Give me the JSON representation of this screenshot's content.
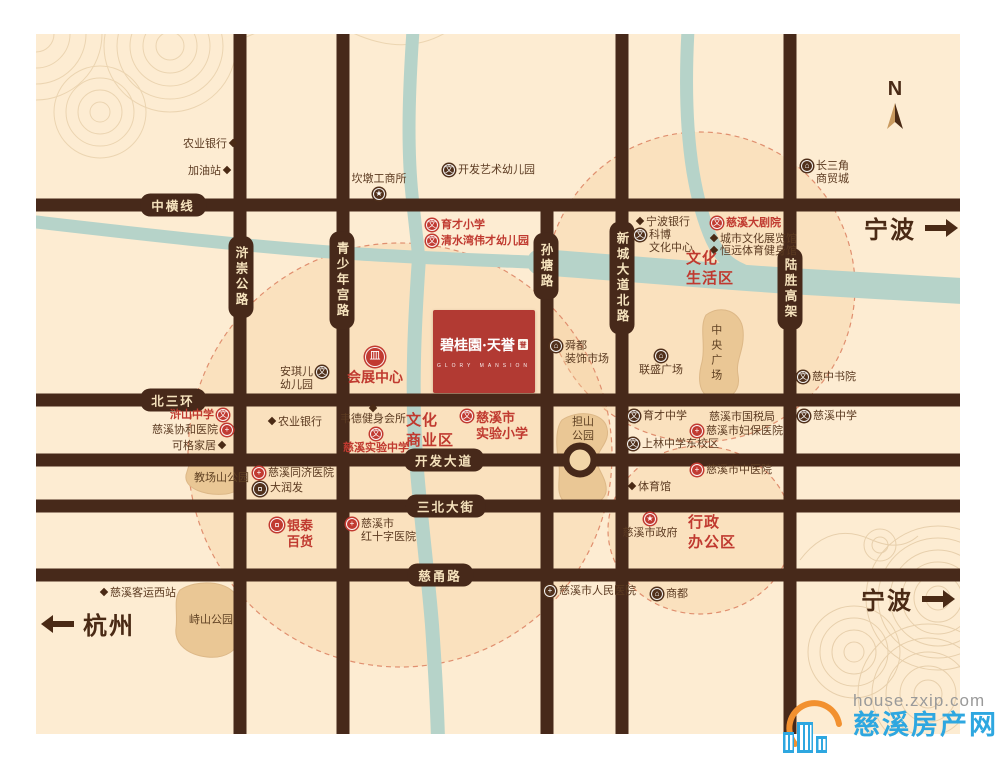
{
  "map": {
    "compass_label": "N",
    "project": {
      "name": "碧桂園·天誉",
      "seal": "誉",
      "subtitle": "GLORY MANSION"
    },
    "icon_glyphs": {
      "school": "文",
      "hospital": "+",
      "building": "⌂",
      "cart": "¤",
      "bank": "皿",
      "star": "★"
    },
    "colors": {
      "accent_red": "#c0392f",
      "road_brown": "#47291a",
      "river": "#b6d3c9",
      "cream": "#fdecd2",
      "park": "#eac795"
    },
    "road_labels": {
      "horizontal": [
        {
          "id": "zhonghengxian",
          "label": "中横线",
          "x": 173,
          "y": 205
        },
        {
          "id": "beisanhuan",
          "label": "北三环",
          "x": 173,
          "y": 400
        },
        {
          "id": "kaifa-avenue",
          "label": "开发大道",
          "x": 444,
          "y": 460
        },
        {
          "id": "sanbei-street",
          "label": "三北大街",
          "x": 446,
          "y": 506
        },
        {
          "id": "ciyong-road",
          "label": "慈甬路",
          "x": 440,
          "y": 575
        }
      ],
      "vertical": [
        {
          "id": "huchong-highway",
          "label": "浒崇公路",
          "x": 241,
          "y": 277
        },
        {
          "id": "qingshaoniangong-road",
          "label": "青少年宫路",
          "x": 342,
          "y": 280
        },
        {
          "id": "suntang-road",
          "label": "孙塘路",
          "x": 546,
          "y": 266
        },
        {
          "id": "xincheng-avenue-north",
          "label": "新城大道北路",
          "x": 622,
          "y": 278
        },
        {
          "id": "lusheng-viaduct",
          "label": "陆胜高架",
          "x": 790,
          "y": 289
        }
      ]
    },
    "districts": [
      {
        "id": "culture-living-zone",
        "label": "文化\n生活区",
        "x": 686,
        "y": 249
      },
      {
        "id": "culture-business-zone",
        "label": "文化\n商业区",
        "x": 406,
        "y": 411
      },
      {
        "id": "admin-office-zone",
        "label": "行政\n办公区",
        "x": 688,
        "y": 513
      }
    ],
    "parks": [
      {
        "id": "jiaochangshan-park",
        "label": "教场山公园",
        "x": 194,
        "y": 472
      },
      {
        "id": "danshan-park",
        "label": "担山\n公园",
        "x": 564,
        "y": 416,
        "center": true,
        "w": 38
      },
      {
        "id": "zhongyang-plaza",
        "label": "中央广场",
        "x": 708,
        "y": 324,
        "vertical": true
      },
      {
        "id": "zhishan-park",
        "label": "峙山公园",
        "x": 189,
        "y": 614
      }
    ],
    "pois": [
      {
        "id": "agri-bank-north",
        "label": "农业银行",
        "icon": "pin",
        "side": "right",
        "x": 183,
        "y": 138
      },
      {
        "id": "gas-station",
        "label": "加油站",
        "icon": "pin",
        "side": "right",
        "x": 188,
        "y": 165
      },
      {
        "id": "kandun-industry-office",
        "label": "坎墩工商所",
        "icon": "star-dark",
        "side": "bottom",
        "x": 341,
        "y": 173,
        "w": 76
      },
      {
        "id": "kaifa-art-kindergarten",
        "label": "开发艺术幼儿园",
        "icon": "school-dark",
        "side": "left",
        "x": 443,
        "y": 164
      },
      {
        "id": "yucai-primary-school",
        "label": "育才小学",
        "icon": "school-red",
        "side": "left",
        "accent": true,
        "x": 426,
        "y": 219
      },
      {
        "id": "qingshuiwan-kindergarten",
        "label": "清水湾伟才幼儿园",
        "icon": "school-red",
        "side": "left",
        "accent": true,
        "x": 426,
        "y": 235
      },
      {
        "id": "ningbo-bank",
        "label": "宁波银行",
        "icon": "pin",
        "side": "left",
        "x": 637,
        "y": 216
      },
      {
        "id": "kebo-culture-center",
        "label": "科博\n文化中心",
        "icon": "school-dark",
        "side": "left",
        "x": 634,
        "y": 229
      },
      {
        "id": "cixi-grand-theatre",
        "label": "慈溪大剧院",
        "icon": "school-red",
        "side": "left",
        "accent": true,
        "x": 711,
        "y": 217
      },
      {
        "id": "city-culture-expo-hall",
        "label": "城市文化展览馆",
        "icon": "pin",
        "side": "left",
        "x": 711,
        "y": 233
      },
      {
        "id": "hengyuan-sports-gym",
        "label": "恒远体育健身馆",
        "icon": "pin",
        "side": "left",
        "x": 711,
        "y": 245
      },
      {
        "id": "changsanjiao-trade-city",
        "label": "长三角\n商贸城",
        "icon": "building-dark",
        "side": "left",
        "x": 801,
        "y": 160
      },
      {
        "id": "anqier-kindergarten",
        "label": "安琪儿\n幼儿园",
        "icon": "school-dark",
        "side": "right",
        "x": 280,
        "y": 366
      },
      {
        "id": "convention-center",
        "label": "会展中心",
        "icon": "bank-red",
        "side": "top",
        "accent": true,
        "size": 14,
        "x": 343,
        "y": 347,
        "w": 64
      },
      {
        "id": "shundu-decor-market",
        "label": "舜都\n装饰市场",
        "icon": "building-dark",
        "side": "left",
        "x": 550,
        "y": 340
      },
      {
        "id": "liansheng-plaza",
        "label": "联盛广场",
        "icon": "building-dark",
        "side": "top",
        "x": 631,
        "y": 350,
        "w": 60
      },
      {
        "id": "cizhong-academy",
        "label": "慈中书院",
        "icon": "school-dark",
        "side": "left",
        "x": 797,
        "y": 371
      },
      {
        "id": "hushan-middle-school",
        "label": "浒山中学",
        "icon": "school-red",
        "side": "right",
        "accent": true,
        "x": 170,
        "y": 409
      },
      {
        "id": "xiehe-hospital",
        "label": "慈溪协和医院",
        "icon": "hospital-red",
        "side": "right",
        "x": 152,
        "y": 424
      },
      {
        "id": "kege-home",
        "label": "可格家居",
        "icon": "pin",
        "side": "right",
        "x": 172,
        "y": 440
      },
      {
        "id": "agri-bank-west",
        "label": "农业银行",
        "icon": "pin",
        "side": "left",
        "x": 269,
        "y": 416
      },
      {
        "id": "weide-fitness-club",
        "label": "韦德健身会所",
        "icon": "pin",
        "side": "top",
        "x": 336,
        "y": 403,
        "w": 74
      },
      {
        "id": "cixi-experimental-middle-school",
        "label": "慈溪实验中学",
        "icon": "school-red",
        "side": "top",
        "accent": true,
        "x": 339,
        "y": 428,
        "w": 74
      },
      {
        "id": "cixi-experimental-primary-school",
        "label": "慈溪市\n实验小学",
        "icon": "school-red",
        "side": "left",
        "accent": true,
        "size": 13,
        "x": 461,
        "y": 410
      },
      {
        "id": "yucai-middle-school",
        "label": "育才中学",
        "icon": "school-dark",
        "side": "left",
        "x": 628,
        "y": 410
      },
      {
        "id": "tax-bureau",
        "label": "慈溪市国税局",
        "icon": "none",
        "x": 709,
        "y": 411
      },
      {
        "id": "fubao-hospital",
        "label": "慈溪市妇保医院",
        "icon": "hospital-red",
        "side": "left",
        "x": 691,
        "y": 425
      },
      {
        "id": "shanglin-middle-school-east",
        "label": "上林中学东校区",
        "icon": "school-dark",
        "side": "left",
        "x": 627,
        "y": 438
      },
      {
        "id": "tcm-hospital",
        "label": "慈溪市中医院",
        "icon": "hospital-red",
        "side": "left",
        "x": 691,
        "y": 464
      },
      {
        "id": "stadium",
        "label": "体育馆",
        "icon": "pin",
        "side": "left",
        "x": 629,
        "y": 481
      },
      {
        "id": "cixi-middle-school",
        "label": "慈溪中学",
        "icon": "school-dark",
        "side": "left",
        "x": 798,
        "y": 410
      },
      {
        "id": "tongji-hospital",
        "label": "慈溪同济医院",
        "icon": "hospital-red",
        "side": "left",
        "x": 253,
        "y": 467
      },
      {
        "id": "darunfa-supermarket",
        "label": "大润发",
        "icon": "cart-dark",
        "side": "left",
        "x": 253,
        "y": 482
      },
      {
        "id": "yintai-department-store",
        "label": "银泰\n百货",
        "icon": "cart-red",
        "side": "left",
        "accent": true,
        "size": 13,
        "x": 270,
        "y": 518
      },
      {
        "id": "red-cross-hospital",
        "label": "慈溪市\n红十字医院",
        "icon": "hospital-red",
        "side": "left",
        "x": 346,
        "y": 518
      },
      {
        "id": "city-government",
        "label": "慈溪市政府",
        "icon": "star-red",
        "side": "top",
        "x": 617,
        "y": 513,
        "w": 66
      },
      {
        "id": "west-bus-station",
        "label": "慈溪客运西站",
        "icon": "pin",
        "side": "left",
        "x": 101,
        "y": 587
      },
      {
        "id": "renmin-hospital",
        "label": "慈溪市人民医院",
        "icon": "hospital-dark",
        "side": "left",
        "x": 544,
        "y": 585
      },
      {
        "id": "shangdu-mall",
        "label": "商都",
        "icon": "building-dark",
        "side": "left",
        "x": 651,
        "y": 588
      }
    ],
    "directions": [
      {
        "id": "to-ningbo-north",
        "label": "宁波",
        "dir": "right",
        "x": 864,
        "y": 210
      },
      {
        "id": "to-ningbo-south",
        "label": "宁波",
        "dir": "right",
        "x": 861,
        "y": 581
      },
      {
        "id": "to-hangzhou",
        "label": "杭州",
        "dir": "left",
        "x": 52,
        "y": 606
      }
    ]
  },
  "watermark": {
    "url": "house.zxip.com",
    "site": "慈溪房产网"
  }
}
